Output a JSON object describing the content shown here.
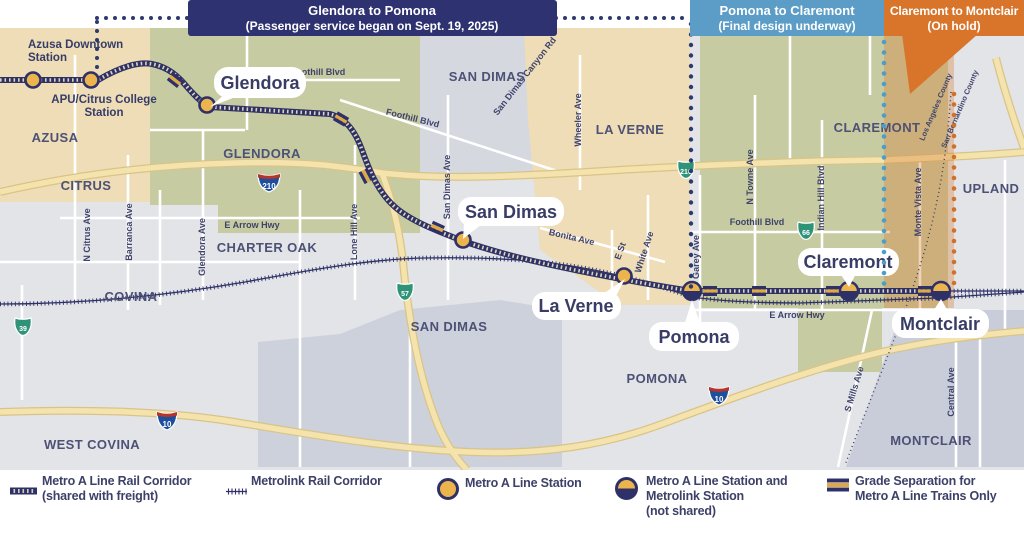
{
  "banners": {
    "seg1": {
      "line1": "Glendora to Pomona",
      "line2": "(Passenger service began on Sept. 19, 2025)",
      "color": "#2e3270"
    },
    "seg2": {
      "line1": "Pomona to Claremont",
      "line2": "(Final design underway)",
      "color": "#5b9dc6"
    },
    "seg3": {
      "line1": "Claremont to Montclair",
      "line2": "(On hold)",
      "color": "#d8752b"
    }
  },
  "stations": {
    "azusa_downtown": {
      "line1": "Azusa Downtown",
      "line2": "Station"
    },
    "apu_citrus": {
      "line1": "APU/Citrus College",
      "line2": "Station"
    },
    "glendora": "Glendora",
    "san_dimas": "San Dimas",
    "la_verne": "La Verne",
    "pomona": "Pomona",
    "claremont": "Claremont",
    "montclair": "Montclair"
  },
  "cities": {
    "azusa": "AZUSA",
    "citrus": "CITRUS",
    "glendora": "GLENDORA",
    "charter_oak": "CHARTER OAK",
    "covina": "COVINA",
    "west_covina": "WEST COVINA",
    "san_dimas_north": "SAN DIMAS",
    "san_dimas_south": "SAN DIMAS",
    "la_verne": "LA VERNE",
    "pomona": "POMONA",
    "claremont": "CLAREMONT",
    "upland": "UPLAND",
    "montclair": "MONTCLAIR"
  },
  "streets": {
    "foothill_west": "Foothill Blvd",
    "foothill_central": "Foothill Blvd",
    "foothill_east": "Foothill Blvd",
    "san_dimas_canyon": "San Dimas Canyon Rd",
    "wheeler": "Wheeler Ave",
    "n_citrus": "N Citrus Ave",
    "barranca": "Barranca Ave",
    "glendora_ave": "Glendora Ave",
    "e_arrow_west": "E Arrow Hwy",
    "e_arrow_east": "E Arrow Hwy",
    "lone_hill": "Lone Hill Ave",
    "san_dimas_ave": "San Dimas Ave",
    "bonita": "Bonita Ave",
    "e_st": "E St",
    "white": "White Ave",
    "garey": "Garey Ave",
    "n_towne": "N Towne Ave",
    "indian_hill": "Indian Hill Blvd",
    "monte_vista": "Monte Vista Ave",
    "s_mills": "S Mills Ave",
    "central": "Central Ave"
  },
  "counties": {
    "la": "Los Angeles County",
    "sb": "San Bernardino County"
  },
  "shields": {
    "i210": "210",
    "sr210": "210",
    "sr57": "57",
    "sr39": "39",
    "sr66": "66",
    "i10_west": "10",
    "i10_east": "10"
  },
  "legend": {
    "a_line_corridor": {
      "line1": "Metro A Line Rail Corridor",
      "line2": "(shared with freight)"
    },
    "metrolink_corridor": {
      "label": "Metrolink Rail Corridor"
    },
    "a_line_station": {
      "label": "Metro A Line Station"
    },
    "shared_station": {
      "line1": "Metro A Line Station and",
      "line2": "Metrolink Station",
      "line3": "(not shared)"
    },
    "grade_separation": {
      "line1": "Grade Separation for",
      "line2": "Metro A Line Trains Only"
    }
  },
  "colors": {
    "navy": "#2e3270",
    "blue": "#5b9dc6",
    "orange": "#d8752b",
    "station_gold": "#ecb44d",
    "olive_region": "#c7cba1",
    "tan_region": "#eeddb6",
    "gray_region": "#c9cdd9",
    "freeway_tan": "#f4e3ad"
  }
}
